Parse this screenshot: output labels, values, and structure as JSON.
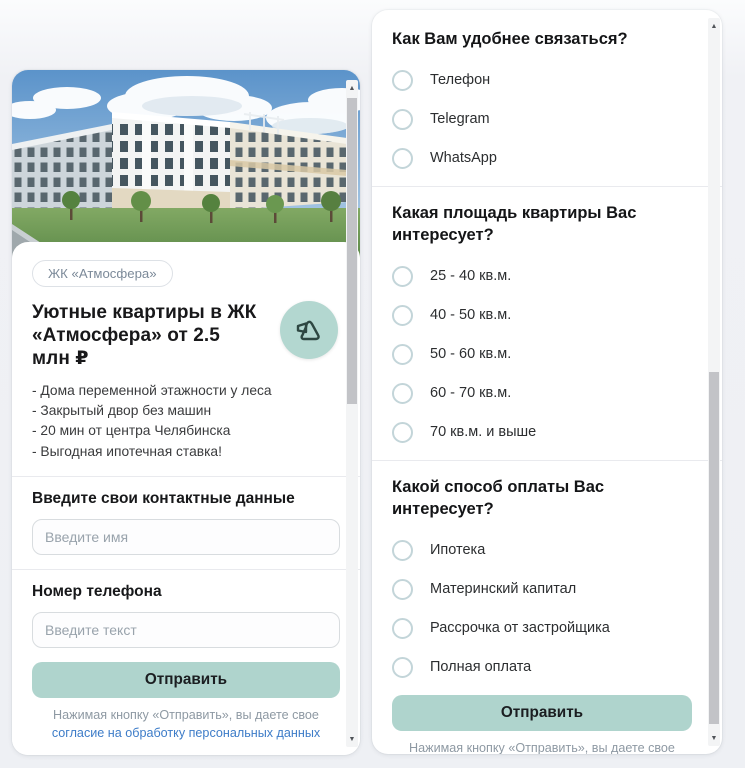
{
  "left_card": {
    "badge": "ЖК «Атмосфера»",
    "title": "Уютные квартиры в ЖК «Атмосфера» от 2.5 млн ₽",
    "bullets": [
      "- Дома переменной этажности у леса",
      "- Закрытый двор без машин",
      "- 20 мин от центра Челябинска",
      "- Выгодная ипотечная ставка!"
    ],
    "contact_heading": "Введите свои контактные данные",
    "name_placeholder": "Введите имя",
    "phone_heading": "Номер телефона",
    "phone_placeholder": "Введите текст",
    "submit_label": "Отправить",
    "consent_text": "Нажимая кнопку «Отправить», вы даете свое",
    "consent_link": "согласие на обработку персональных данных"
  },
  "survey": {
    "questions": [
      {
        "title": "Как Вам удобнее связаться?",
        "options": [
          "Телефон",
          "Telegram",
          "WhatsApp"
        ]
      },
      {
        "title": "Какая площадь квартиры Вас интересует?",
        "options": [
          "25 - 40 кв.м.",
          "40 - 50 кв.м.",
          "50 - 60 кв.м.",
          "60 - 70 кв.м.",
          "70 кв.м. и выше"
        ]
      },
      {
        "title": "Какой способ оплаты Вас интересует?",
        "options": [
          "Ипотека",
          "Материнский капитал",
          "Рассрочка от застройщика",
          "Полная оплата"
        ]
      }
    ],
    "submit_label": "Отправить",
    "consent_text": "Нажимая кнопку «Отправить», вы даете свое",
    "consent_link": "согласие на обработку персональных данных"
  },
  "colors": {
    "accent_button": "#afd4cd",
    "logo_circle": "#b3d7d0",
    "link": "#3d7cc8",
    "radio_border": "#c3d5d9",
    "badge_text": "#7c8a99",
    "page_bg": "#eef0f4"
  },
  "icons": {
    "scroll_up": "▲",
    "scroll_down": "▼"
  }
}
